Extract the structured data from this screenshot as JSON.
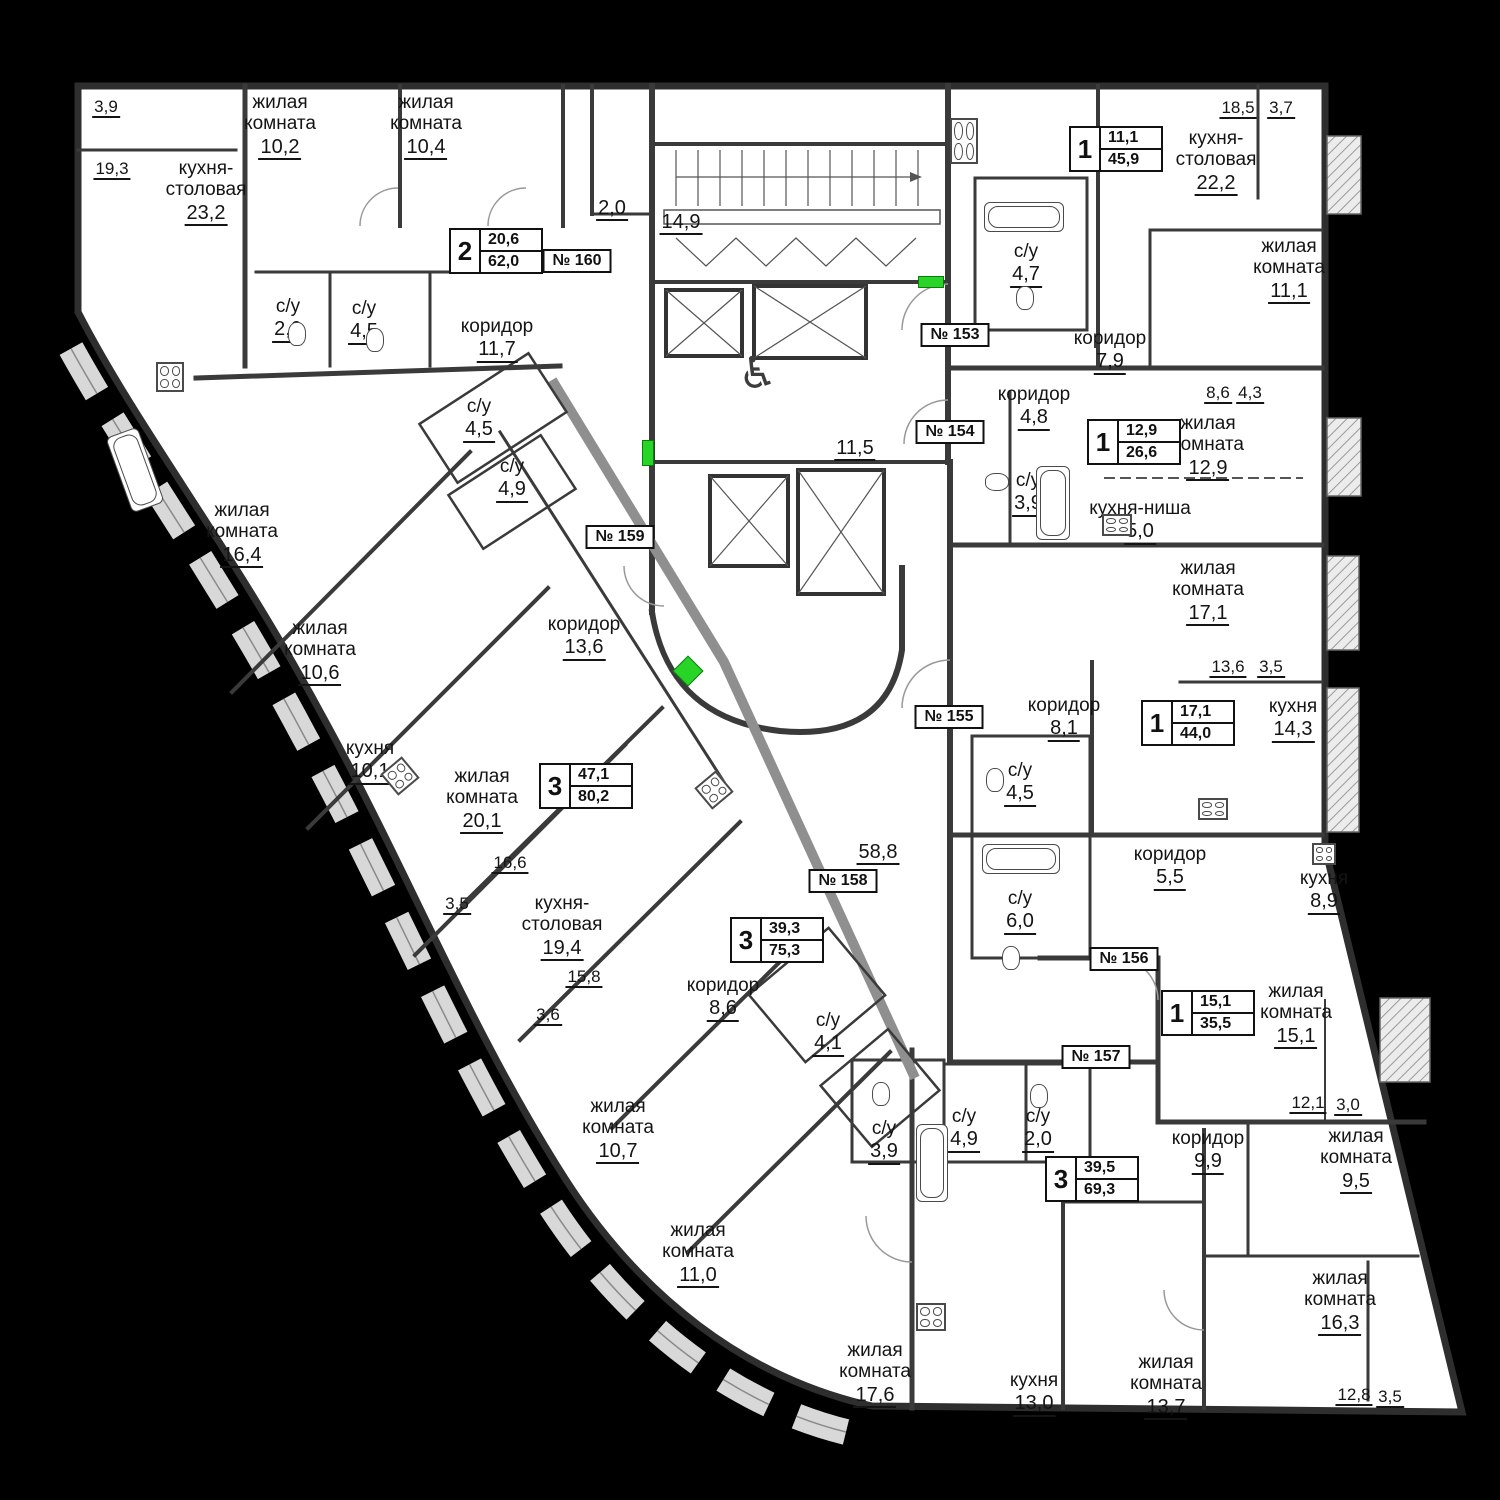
{
  "colors": {
    "background": "#000000",
    "floor": "#ffffff",
    "wall_dark": "#3a3a3a",
    "wall_light": "#8f8f8f",
    "loggia_band": "#d8d8d8",
    "entry_marker": "#28d428",
    "text": "#141414"
  },
  "rooms": [
    {
      "name": "жилая\nкомната",
      "value": "10,2",
      "x": 280,
      "y": 92
    },
    {
      "name": "жилая\nкомната",
      "value": "10,4",
      "x": 426,
      "y": 92
    },
    {
      "name": "кухня-\nстоловая",
      "value": "23,2",
      "x": 206,
      "y": 158
    },
    {
      "name": "с/у",
      "value": "2,0",
      "x": 288,
      "y": 296
    },
    {
      "name": "с/у",
      "value": "4,5",
      "x": 364,
      "y": 298
    },
    {
      "name": "коридор",
      "value": "11,7",
      "x": 497,
      "y": 316
    },
    {
      "name": "",
      "value": "2,0",
      "x": 612,
      "y": 196
    },
    {
      "name": "",
      "value": "14,9",
      "x": 681,
      "y": 210
    },
    {
      "name": "",
      "value": "11,5",
      "x": 855,
      "y": 436
    },
    {
      "name": "",
      "value": "58,8",
      "x": 878,
      "y": 840
    },
    {
      "name": "с/у",
      "value": "4,7",
      "x": 1026,
      "y": 241
    },
    {
      "name": "кухня-\nстоловая",
      "value": "22,2",
      "x": 1216,
      "y": 128
    },
    {
      "name": "жилая\nкомната",
      "value": "11,1",
      "x": 1289,
      "y": 236
    },
    {
      "name": "коридор",
      "value": "7,9",
      "x": 1110,
      "y": 328
    },
    {
      "name": "коридор",
      "value": "4,8",
      "x": 1034,
      "y": 384
    },
    {
      "name": "жилая\nкомната",
      "value": "12,9",
      "x": 1208,
      "y": 413
    },
    {
      "name": "с/у",
      "value": "3,9",
      "x": 1028,
      "y": 470
    },
    {
      "name": "кухня-ниша",
      "value": "5,0",
      "x": 1140,
      "y": 498
    },
    {
      "name": "жилая\nкомната",
      "value": "17,1",
      "x": 1208,
      "y": 558
    },
    {
      "name": "коридор",
      "value": "8,1",
      "x": 1064,
      "y": 695
    },
    {
      "name": "кухня",
      "value": "14,3",
      "x": 1293,
      "y": 696
    },
    {
      "name": "с/у",
      "value": "4,5",
      "x": 1020,
      "y": 760
    },
    {
      "name": "с/у",
      "value": "6,0",
      "x": 1020,
      "y": 888
    },
    {
      "name": "коридор",
      "value": "5,5",
      "x": 1170,
      "y": 844
    },
    {
      "name": "кухня",
      "value": "8,9",
      "x": 1324,
      "y": 868
    },
    {
      "name": "жилая\nкомната",
      "value": "15,1",
      "x": 1296,
      "y": 981
    },
    {
      "name": "коридор",
      "value": "9,9",
      "x": 1208,
      "y": 1128
    },
    {
      "name": "жилая\nкомната",
      "value": "9,5",
      "x": 1356,
      "y": 1126
    },
    {
      "name": "жилая\nкомната",
      "value": "16,3",
      "x": 1340,
      "y": 1268
    },
    {
      "name": "жилая\nкомната",
      "value": "13,7",
      "x": 1166,
      "y": 1352
    },
    {
      "name": "кухня",
      "value": "13,0",
      "x": 1034,
      "y": 1370
    },
    {
      "name": "жилая\nкомната",
      "value": "17,6",
      "x": 875,
      "y": 1340
    },
    {
      "name": "жилая\nкомната",
      "value": "11,0",
      "x": 698,
      "y": 1220
    },
    {
      "name": "жилая\nкомната",
      "value": "10,7",
      "x": 618,
      "y": 1096
    },
    {
      "name": "с/у",
      "value": "3,9",
      "x": 884,
      "y": 1118
    },
    {
      "name": "с/у",
      "value": "4,9",
      "x": 964,
      "y": 1106
    },
    {
      "name": "с/у",
      "value": "2,0",
      "x": 1038,
      "y": 1106
    },
    {
      "name": "кухня-\nстоловая",
      "value": "19,4",
      "x": 562,
      "y": 893
    },
    {
      "name": "коридор",
      "value": "8,6",
      "x": 723,
      "y": 975
    },
    {
      "name": "с/у",
      "value": "4,1",
      "x": 828,
      "y": 1010
    },
    {
      "name": "жилая\nкомната",
      "value": "20,1",
      "x": 482,
      "y": 766
    },
    {
      "name": "коридор",
      "value": "13,6",
      "x": 584,
      "y": 614
    },
    {
      "name": "кухня",
      "value": "10,1",
      "x": 370,
      "y": 738
    },
    {
      "name": "жилая\nкомната",
      "value": "10,6",
      "x": 320,
      "y": 618
    },
    {
      "name": "жилая\nкомната",
      "value": "16,4",
      "x": 242,
      "y": 500
    },
    {
      "name": "с/у",
      "value": "4,5",
      "x": 479,
      "y": 396
    },
    {
      "name": "с/у",
      "value": "4,9",
      "x": 512,
      "y": 456
    }
  ],
  "dimensions": [
    {
      "value": "3,9",
      "x": 106,
      "y": 96
    },
    {
      "value": "19,3",
      "x": 112,
      "y": 158
    },
    {
      "value": "18,5",
      "x": 1238,
      "y": 97
    },
    {
      "value": "3,7",
      "x": 1281,
      "y": 97
    },
    {
      "value": "8,6",
      "x": 1218,
      "y": 382
    },
    {
      "value": "4,3",
      "x": 1250,
      "y": 382
    },
    {
      "value": "13,6",
      "x": 1228,
      "y": 656
    },
    {
      "value": "3,5",
      "x": 1271,
      "y": 656
    },
    {
      "value": "16,6",
      "x": 510,
      "y": 852
    },
    {
      "value": "3,5",
      "x": 457,
      "y": 893
    },
    {
      "value": "15,8",
      "x": 584,
      "y": 966
    },
    {
      "value": "3,6",
      "x": 548,
      "y": 1004
    },
    {
      "value": "12,1",
      "x": 1308,
      "y": 1092
    },
    {
      "value": "3,0",
      "x": 1348,
      "y": 1094
    },
    {
      "value": "12,8",
      "x": 1354,
      "y": 1384
    },
    {
      "value": "3,5",
      "x": 1390,
      "y": 1386
    }
  ],
  "stat_badges": [
    {
      "rooms": "2",
      "living": "20,6",
      "total": "62,0",
      "x": 496,
      "y": 251
    },
    {
      "rooms": "1",
      "living": "11,1",
      "total": "45,9",
      "x": 1116,
      "y": 149
    },
    {
      "rooms": "1",
      "living": "12,9",
      "total": "26,6",
      "x": 1134,
      "y": 442
    },
    {
      "rooms": "1",
      "living": "17,1",
      "total": "44,0",
      "x": 1188,
      "y": 723
    },
    {
      "rooms": "1",
      "living": "15,1",
      "total": "35,5",
      "x": 1208,
      "y": 1013
    },
    {
      "rooms": "3",
      "living": "39,5",
      "total": "69,3",
      "x": 1092,
      "y": 1179
    },
    {
      "rooms": "3",
      "living": "39,3",
      "total": "75,3",
      "x": 777,
      "y": 940
    },
    {
      "rooms": "3",
      "living": "47,1",
      "total": "80,2",
      "x": 586,
      "y": 786
    }
  ],
  "unit_plates": [
    {
      "text": "№ 153",
      "x": 955,
      "y": 335
    },
    {
      "text": "№ 154",
      "x": 950,
      "y": 432
    },
    {
      "text": "№ 155",
      "x": 949,
      "y": 717
    },
    {
      "text": "№ 156",
      "x": 1124,
      "y": 959
    },
    {
      "text": "№ 157",
      "x": 1096,
      "y": 1057
    },
    {
      "text": "№ 158",
      "x": 843,
      "y": 881
    },
    {
      "text": "№ 159",
      "x": 620,
      "y": 537
    },
    {
      "text": "№ 160",
      "x": 577,
      "y": 261
    }
  ],
  "icons": [
    {
      "type": "stove",
      "x": 156,
      "y": 362,
      "w": 28,
      "h": 30,
      "rot": 0
    },
    {
      "type": "stove",
      "x": 950,
      "y": 118,
      "w": 28,
      "h": 46,
      "rot": 0
    },
    {
      "type": "stove",
      "x": 1102,
      "y": 514,
      "w": 30,
      "h": 22,
      "rot": 0
    },
    {
      "type": "stove",
      "x": 1198,
      "y": 798,
      "w": 30,
      "h": 22,
      "rot": 0
    },
    {
      "type": "stove",
      "x": 1312,
      "y": 843,
      "w": 24,
      "h": 22,
      "rot": 0
    },
    {
      "type": "stove",
      "x": 916,
      "y": 1303,
      "w": 30,
      "h": 28,
      "rot": 0
    },
    {
      "type": "stove",
      "x": 386,
      "y": 762,
      "w": 28,
      "h": 28,
      "rot": -40
    },
    {
      "type": "stove",
      "x": 700,
      "y": 776,
      "w": 28,
      "h": 28,
      "rot": -40
    },
    {
      "type": "wheelchair",
      "x": 738,
      "y": 352,
      "w": 48,
      "h": 52,
      "rot": 0
    },
    {
      "type": "entry-marker",
      "x": 918,
      "y": 276,
      "w": 26,
      "h": 12,
      "rot": 0
    },
    {
      "type": "entry-marker",
      "x": 642,
      "y": 440,
      "w": 12,
      "h": 26,
      "rot": 0
    },
    {
      "type": "entry-marker",
      "x": 677,
      "y": 660,
      "w": 22,
      "h": 22,
      "rot": 45
    },
    {
      "type": "bathtub",
      "x": 984,
      "y": 202,
      "w": 80,
      "h": 30,
      "rot": 0
    },
    {
      "type": "bathtub",
      "x": 1036,
      "y": 466,
      "w": 34,
      "h": 74,
      "rot": 0
    },
    {
      "type": "bathtub",
      "x": 982,
      "y": 844,
      "w": 78,
      "h": 30,
      "rot": 0
    },
    {
      "type": "bathtub",
      "x": 916,
      "y": 1124,
      "w": 32,
      "h": 78,
      "rot": 0
    },
    {
      "type": "bathtub",
      "x": 118,
      "y": 430,
      "w": 34,
      "h": 80,
      "rot": -20
    },
    {
      "type": "toilet",
      "x": 288,
      "y": 322,
      "w": 18,
      "h": 24,
      "rot": 0
    },
    {
      "type": "toilet",
      "x": 366,
      "y": 328,
      "w": 18,
      "h": 24,
      "rot": 0
    },
    {
      "type": "toilet",
      "x": 1016,
      "y": 286,
      "w": 18,
      "h": 24,
      "rot": 0
    },
    {
      "type": "toilet",
      "x": 988,
      "y": 470,
      "w": 18,
      "h": 24,
      "rot": 90
    },
    {
      "type": "toilet",
      "x": 986,
      "y": 768,
      "w": 18,
      "h": 24,
      "rot": 0
    },
    {
      "type": "toilet",
      "x": 1002,
      "y": 946,
      "w": 18,
      "h": 24,
      "rot": 0
    },
    {
      "type": "toilet",
      "x": 872,
      "y": 1082,
      "w": 18,
      "h": 24,
      "rot": 0
    },
    {
      "type": "toilet",
      "x": 1030,
      "y": 1084,
      "w": 18,
      "h": 24,
      "rot": 0
    }
  ]
}
